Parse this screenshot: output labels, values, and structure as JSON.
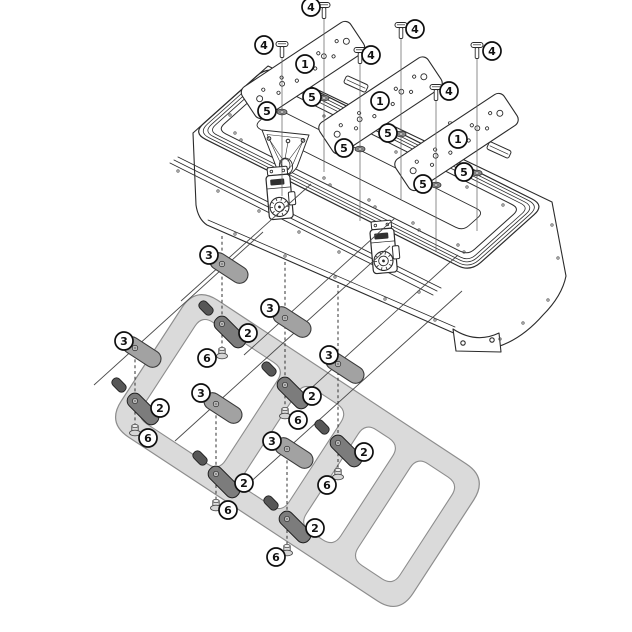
{
  "diagram": {
    "title": "top-case-mounting-exploded-diagram",
    "background": "#ffffff",
    "width": 632,
    "height": 632
  },
  "colors": {
    "line": "#2b2b2b",
    "thin_line": "#555555",
    "leader": "#4a4a4a",
    "dash": "#333333",
    "rack_fill": "#dadada",
    "rack_stroke": "#8d8d8d",
    "slot_fill": "#ffffff",
    "pad_fill": "#a2a2a2",
    "pad_stroke": "#3a3a3a",
    "clamp_fill": "#7c7c7c",
    "clamp_stroke": "#1f1f1f",
    "nub_fill": "#575757",
    "nut_fill": "#d6d6d6",
    "nut_stroke": "#4a4a4a",
    "washer_fill": "#8a8a8a",
    "washer_stroke": "#333333",
    "callout_fill": "#ffffff",
    "callout_stroke": "#0f0f0f",
    "label_fill": "#2f2f2f"
  },
  "callouts": [
    {
      "n": "4",
      "x": 264,
      "y": 45
    },
    {
      "n": "4",
      "x": 311,
      "y": 7
    },
    {
      "n": "4",
      "x": 371,
      "y": 55
    },
    {
      "n": "4",
      "x": 415,
      "y": 29
    },
    {
      "n": "4",
      "x": 449,
      "y": 91
    },
    {
      "n": "4",
      "x": 492,
      "y": 51
    },
    {
      "n": "1",
      "x": 305,
      "y": 64
    },
    {
      "n": "1",
      "x": 380,
      "y": 101
    },
    {
      "n": "1",
      "x": 458,
      "y": 139
    },
    {
      "n": "5",
      "x": 267,
      "y": 111
    },
    {
      "n": "5",
      "x": 312,
      "y": 97
    },
    {
      "n": "5",
      "x": 344,
      "y": 148
    },
    {
      "n": "5",
      "x": 388,
      "y": 133
    },
    {
      "n": "5",
      "x": 423,
      "y": 184
    },
    {
      "n": "5",
      "x": 464,
      "y": 172
    },
    {
      "n": "3",
      "x": 209,
      "y": 255
    },
    {
      "n": "3",
      "x": 124,
      "y": 341
    },
    {
      "n": "3",
      "x": 270,
      "y": 308
    },
    {
      "n": "3",
      "x": 201,
      "y": 393
    },
    {
      "n": "3",
      "x": 329,
      "y": 355
    },
    {
      "n": "3",
      "x": 272,
      "y": 441
    },
    {
      "n": "2",
      "x": 248,
      "y": 333
    },
    {
      "n": "2",
      "x": 160,
      "y": 408
    },
    {
      "n": "2",
      "x": 312,
      "y": 396
    },
    {
      "n": "2",
      "x": 244,
      "y": 483
    },
    {
      "n": "2",
      "x": 364,
      "y": 452
    },
    {
      "n": "2",
      "x": 315,
      "y": 528
    },
    {
      "n": "6",
      "x": 207,
      "y": 358
    },
    {
      "n": "6",
      "x": 148,
      "y": 438
    },
    {
      "n": "6",
      "x": 298,
      "y": 420
    },
    {
      "n": "6",
      "x": 228,
      "y": 510
    },
    {
      "n": "6",
      "x": 327,
      "y": 485
    },
    {
      "n": "6",
      "x": 276,
      "y": 557
    }
  ],
  "plates": {
    "angle": -33.5,
    "length": 130,
    "width": 37,
    "items": [
      {
        "cx": 303,
        "cy": 70
      },
      {
        "cx": 380.5,
        "cy": 105.5
      },
      {
        "cx": 456.5,
        "cy": 142
      }
    ]
  },
  "screws": [
    {
      "x": 282,
      "head_y": 44,
      "line_bottom": 196
    },
    {
      "x": 324,
      "head_y": 5,
      "line_bottom": 172
    },
    {
      "x": 360,
      "head_y": 50,
      "line_bottom": 221
    },
    {
      "x": 401,
      "head_y": 25,
      "line_bottom": 199
    },
    {
      "x": 436,
      "head_y": 87,
      "line_bottom": 251
    },
    {
      "x": 477,
      "head_y": 45,
      "line_bottom": 231
    }
  ],
  "washers": [
    {
      "x": 282,
      "y": 112
    },
    {
      "x": 324,
      "y": 98
    },
    {
      "x": 360,
      "y": 149
    },
    {
      "x": 401,
      "y": 134
    },
    {
      "x": 436,
      "y": 185
    },
    {
      "x": 477,
      "y": 173
    }
  ],
  "assembly_sets": [
    {
      "pad": [
        229,
        268
      ],
      "pad_dot": [
        222,
        264
      ],
      "clamp": [
        230,
        332
      ],
      "clamp_dot": [
        222,
        324
      ],
      "nut": [
        222,
        352
      ],
      "dash": [
        222,
        236,
        358
      ],
      "leader": [
        181,
        301,
        311,
        184
      ]
    },
    {
      "pad": [
        142,
        352
      ],
      "pad_dot": [
        135,
        348
      ],
      "clamp": [
        143,
        409
      ],
      "clamp_dot": [
        135,
        401
      ],
      "nut": [
        135,
        429
      ],
      "dash": [
        135,
        342,
        436
      ],
      "leader": [
        94,
        385,
        263,
        232
      ]
    },
    {
      "pad": [
        292,
        322
      ],
      "pad_dot": [
        285,
        318
      ],
      "clamp": [
        293,
        393
      ],
      "clamp_dot": [
        285,
        385
      ],
      "nut": [
        285,
        412
      ],
      "dash": [
        285,
        262,
        419
      ],
      "leader": [
        244,
        355,
        395,
        218
      ]
    },
    {
      "pad": [
        223,
        408
      ],
      "pad_dot": [
        216,
        404
      ],
      "clamp": [
        224,
        482
      ],
      "clamp_dot": [
        216,
        474
      ],
      "nut": [
        216,
        504
      ],
      "dash": [
        216,
        398,
        511
      ],
      "leader": [
        175,
        441,
        390,
        246
      ]
    },
    {
      "pad": [
        345,
        368
      ],
      "pad_dot": [
        338,
        364
      ],
      "clamp": [
        346,
        451
      ],
      "clamp_dot": [
        338,
        443
      ],
      "nut": [
        338,
        473
      ],
      "dash": [
        338,
        285,
        480
      ],
      "leader": [
        297,
        401,
        458,
        255
      ]
    },
    {
      "pad": [
        294,
        453
      ],
      "pad_dot": [
        287,
        449
      ],
      "clamp": [
        295,
        527
      ],
      "clamp_dot": [
        287,
        519
      ],
      "nut": [
        287,
        549
      ],
      "dash": [
        287,
        443,
        556
      ],
      "leader": [
        246,
        486,
        462,
        291
      ]
    }
  ]
}
